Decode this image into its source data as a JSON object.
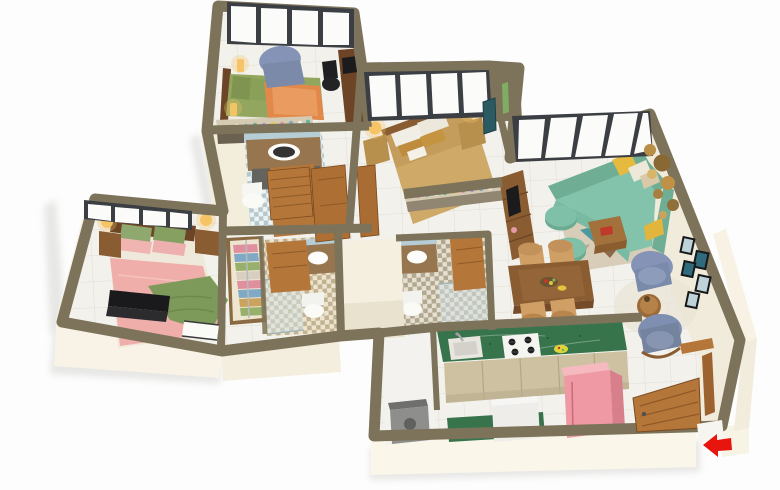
{
  "scene": {
    "type": "3d-isometric-floor-plan",
    "description": "Rendered 3D floor plan of a 3-bedroom apartment with living room, dining area, kitchen, three bathrooms, wardrobe and entrance arrow",
    "entrance": {
      "indicator": "red-arrow",
      "direction": "left"
    }
  },
  "rooms": [
    {
      "name": "guest-bedroom",
      "furniture": [
        "bed-green-orange",
        "armchair-blue",
        "desk-with-monitor",
        "office-chair",
        "candle-lamps",
        "bottle-shelf"
      ]
    },
    {
      "name": "bathroom-top",
      "furniture": [
        "vanity-sink",
        "toilet",
        "wood-door"
      ]
    },
    {
      "name": "middle-bedroom",
      "furniture": [
        "bed-tan",
        "nightstand-left",
        "nightstand-right",
        "lamps",
        "foot-shelf",
        "wall-tv"
      ]
    },
    {
      "name": "living-room",
      "furniture": [
        "sectional-sofa-teal",
        "poufs",
        "rug-geometric",
        "coffee-table",
        "tv-unit",
        "gold-wall-plates",
        "picture-frames"
      ]
    },
    {
      "name": "dining-area",
      "furniture": [
        "dining-table",
        "chairs-tan",
        "fruit-plate"
      ]
    },
    {
      "name": "reading-nook",
      "furniture": [
        "armchair-blue-1",
        "armchair-blue-2",
        "round-side-table",
        "round-rug"
      ]
    },
    {
      "name": "master-bedroom",
      "furniture": [
        "bed-pink",
        "green-blanket",
        "laptop",
        "nightstands",
        "lamps",
        "door-step"
      ]
    },
    {
      "name": "wardrobe",
      "furniture": [
        "clothes-stacks"
      ]
    },
    {
      "name": "master-bathroom",
      "furniture": [
        "vanity-sink",
        "toilet",
        "shower-glass",
        "wood-door"
      ]
    },
    {
      "name": "shared-bathroom",
      "furniture": [
        "vanity-sink",
        "toilet",
        "shower-glass",
        "wood-door"
      ]
    },
    {
      "name": "kitchen",
      "furniture": [
        "green-counter",
        "sink",
        "gas-stove",
        "cabinets",
        "island-counter",
        "dishwasher",
        "pink-fridge"
      ]
    },
    {
      "name": "utility",
      "furniture": [
        "washing-machine"
      ]
    },
    {
      "name": "hallway",
      "furniture": [
        "wardrobe-doors",
        "open-doors"
      ]
    },
    {
      "name": "entry",
      "furniture": [
        "open-entry-door",
        "door-frame",
        "threshold"
      ]
    }
  ],
  "palette": {
    "bg": "#fdfdfd",
    "wall_cap": "#7c735a",
    "wall_cap_dark": "#6b624b",
    "wall_face": "#f7f2e4",
    "wall_face_shade": "#efe8d6",
    "floor_tile": "#f3f1ec",
    "grout": "#e0ddd5",
    "window_frame": "#3b3e42",
    "glass": "#fbfbfa",
    "wood": "#b5763a",
    "wood_dark": "#8f5a26",
    "wood_deep": "#6d4526",
    "wood_mid": "#8a5c32",
    "sofa_teal": "#84c3ab",
    "teal_dark": "#6fae94",
    "pouf_teal": "#7fc0a8",
    "pillow_yellow": "#e6b93f",
    "armchair_blue": "#8594b6",
    "bed_pink": "#efaeaa",
    "pillow_green": "#8fa86f",
    "blanket_green": "#7d9a5b",
    "bed_tan": "#c49d5c",
    "bed_olive": "#93a65f",
    "blanket_orange": "#e1884a",
    "counter_green": "#37744c",
    "cabinet_beige": "#cec1a1",
    "fridge_pink": "#ee99a3",
    "fridge_pink_dark": "#d87f8c",
    "counter_brown": "#96754f",
    "tile_blue": "#b7cdd6",
    "white_fixture": "#f6f6f2",
    "appliance_white": "#eeedea",
    "appliance_gray": "#8e8e8c",
    "lamp_glow": "#f6c465",
    "arrow_red": "#e8150f",
    "rug_beige": "#d8cdb8",
    "rug_teal": "#4b9aa0",
    "rug_yellow": "#e3bd4d",
    "rug_brown": "#8a6a4a",
    "frame_black": "#16181a",
    "art_teal": "#2f6b7c",
    "art_pale": "#bdd3d8",
    "plate_gold": "#c09046",
    "dark_screen": "#1b1b1d",
    "cream_block": "#f5efe0",
    "step_white": "#fafaf6"
  }
}
